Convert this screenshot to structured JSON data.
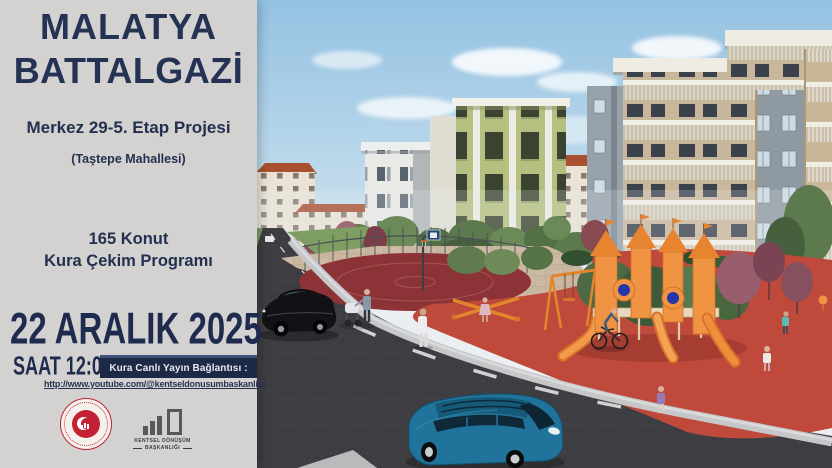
{
  "poster": {
    "location": {
      "city": "MALATYA",
      "district": "BATTALGAZİ"
    },
    "project": {
      "title": "Merkez 29-5. Etap Projesi",
      "neighborhood": "(Taştepe Mahallesi)"
    },
    "program": {
      "line1": "165 Konut",
      "line2": "Kura Çekim Programı"
    },
    "event": {
      "date": "22 ARALIK 2025",
      "time": "SAAT 12:00"
    },
    "stream": {
      "label": "Kura Canlı Yayın Bağlantısı :",
      "url": "http://www.youtube.com/@kentseldonusumbaskanligi"
    },
    "logos": {
      "ministry_seal_icon": "government-red-seal",
      "kentsel": {
        "icon": "city-buildings-logo",
        "line1": "KENTSEL DÖNÜŞÜM",
        "line2": "BAŞKANLIĞI"
      }
    }
  },
  "colors": {
    "panel_bg": "#d3d2d0",
    "navy_text": "#223055",
    "strip_navy": "#1d2a47",
    "seal_red": "#c22234",
    "logo_gray": "#585858",
    "sky_blue": "#9ec8e4",
    "playground_equipment_orange": "#f09443",
    "playground_surface_red": "#bf4a3c",
    "basketball_court_red": "#8c3337",
    "asphalt_gray": "#3e3e42"
  }
}
